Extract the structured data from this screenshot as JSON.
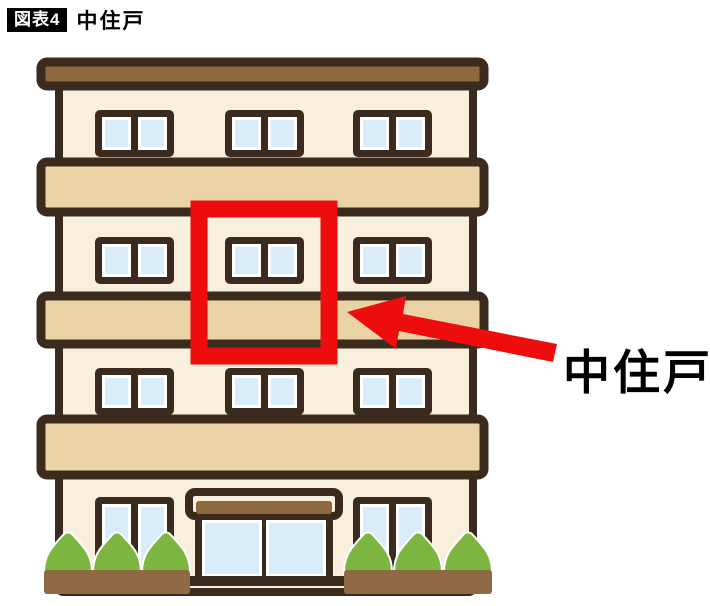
{
  "header": {
    "figure_badge": "図表4",
    "title": "中住戸"
  },
  "annotation": {
    "label": "中住戸",
    "arrow_color": "#ed0d0d",
    "highlight_color": "#ed0d0d"
  },
  "illustration": {
    "type": "apartment-building",
    "floors": 4,
    "upper_floor_window_count_per_floor": 3,
    "highlighted_unit": "middle unit, middle floor",
    "ground_floor": {
      "windows": 2,
      "entrance_door_panels": 2,
      "planters": 2,
      "bushes_per_planter": 3
    },
    "colors": {
      "outline": "#3b2b1f",
      "wall": "#f8f0dd",
      "balcony_band": "#ecd3a6",
      "roof": "#90683f",
      "window_glass": "#d9ecf9",
      "window_trim": "#ffffff",
      "bush_green": "#7cb640",
      "planter_brown": "#8f6a45"
    }
  }
}
